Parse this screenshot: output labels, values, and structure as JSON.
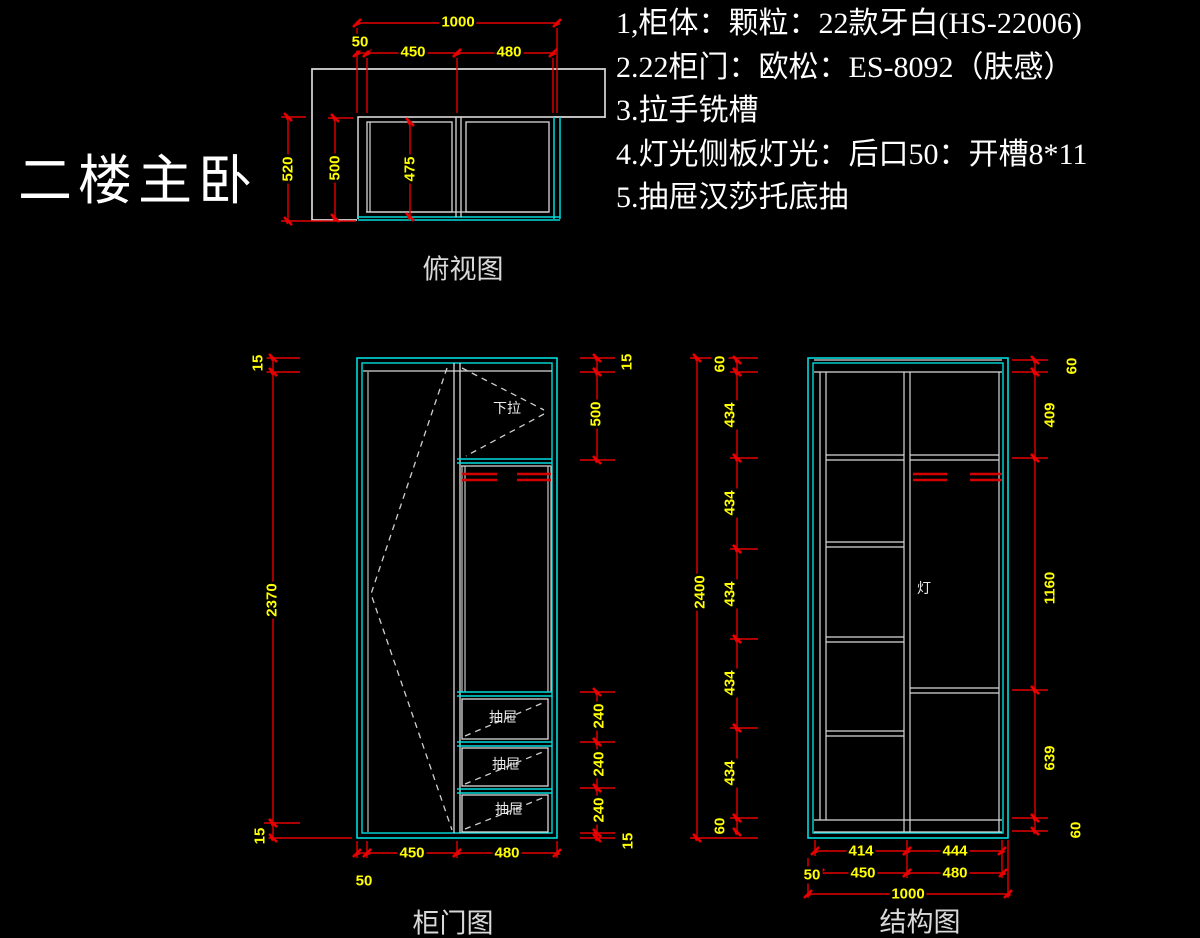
{
  "title": "二楼主卧",
  "notes": [
    "1,柜体：颗粒：22款牙白(HS-22006)",
    "2.22柜门：欧松：ES-8092（肤感）",
    "3.拉手铣槽",
    "4.灯光侧板灯光：后口50：开槽8*11",
    "5.抽屉汉莎托底抽"
  ],
  "colors": {
    "background": "#000000",
    "dimension_line": "#e60000",
    "dimension_text": "#ffff00",
    "cabinet_outline": "#00dcdc",
    "structure_line": "#d9d9d9",
    "hanger_rod": "#d40000"
  },
  "top_view": {
    "label": "俯视图",
    "top_dims": [
      "1000",
      "50",
      "450",
      "480"
    ],
    "side_dims": [
      "520",
      "500",
      "475"
    ]
  },
  "door_view": {
    "label": "柜门图",
    "left_dims": [
      "15",
      "2370",
      "15"
    ],
    "right_dims": [
      "15",
      "500",
      "240",
      "240",
      "240",
      "15"
    ],
    "bottom_dims": [
      "450",
      "480",
      "50"
    ],
    "annotations": {
      "pull_down": "下拉",
      "drawers": [
        "抽屉",
        "抽屉",
        "抽屉"
      ]
    }
  },
  "structure_view": {
    "label": "结构图",
    "overall_left": "2400",
    "left_segments": [
      "60",
      "434",
      "434",
      "434",
      "434",
      "434",
      "60"
    ],
    "right_segments": [
      "60",
      "409",
      "1160",
      "639",
      "60"
    ],
    "bottom_row1": [
      "414",
      "444"
    ],
    "bottom_row2": [
      "50",
      "450",
      "480"
    ],
    "bottom_overall": "1000",
    "annotations": {
      "light": "灯"
    }
  }
}
